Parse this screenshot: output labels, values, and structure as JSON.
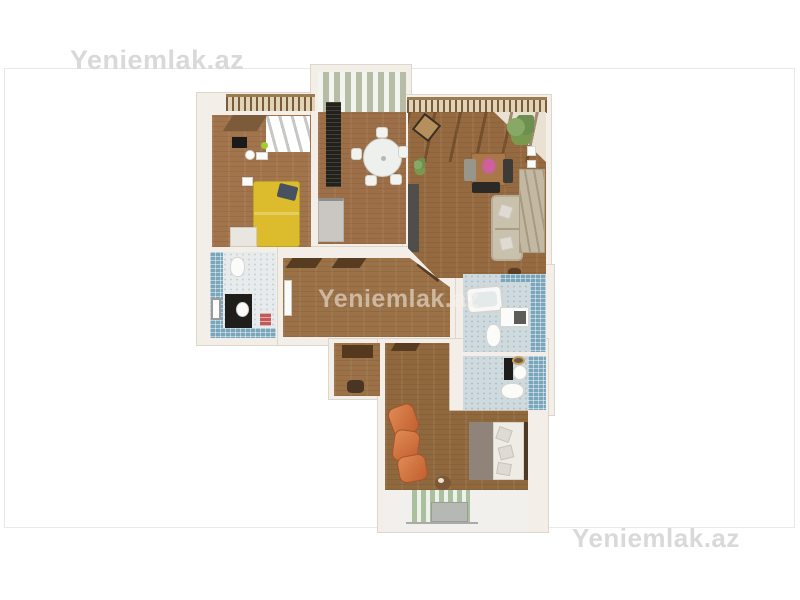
{
  "watermarks": {
    "top_left": "Yeniemlak.az",
    "center": "Yeniemlak.az",
    "bottom_right": "Yeniemlak.az"
  },
  "photo": {
    "description": "3D top-down floor plan render of an apartment",
    "rooms": [
      "office-bedroom",
      "kitchen-dining",
      "living-room",
      "bathroom-left",
      "hallway",
      "entry-closet",
      "bathroom-top-right",
      "bathroom-bottom-right",
      "bedroom",
      "office-balcony",
      "living-balcony",
      "bottom-balcony"
    ]
  },
  "colors": {
    "frame_border": "#eae8e5",
    "wall": "#f3efe8",
    "wall_edge": "#ddd7cb",
    "wood_office": "#a1744c",
    "wood_kitchen": "#9c6f48",
    "wood_living": "#966a40",
    "wood_hall": "#9b7147",
    "wood_bedroom": "#8f683e",
    "tile_blue": "#7aa6bc",
    "bath_floor": "#e7ebec",
    "bath_floor_right": "#cfdade",
    "bed_yellow": "#dcbc2c",
    "sofa_orange": "#d2703c",
    "sofa_beige": "#c9c1ac",
    "curtain_green": "#a9bf9e",
    "kitchen_wall_green": "#a9b294",
    "counter_dark": "#23211c",
    "railing_brown": "#9b7b50",
    "watermark_gray": "#d9d9d9",
    "watermark_on_wood": "rgba(247,243,234,0.55)"
  }
}
